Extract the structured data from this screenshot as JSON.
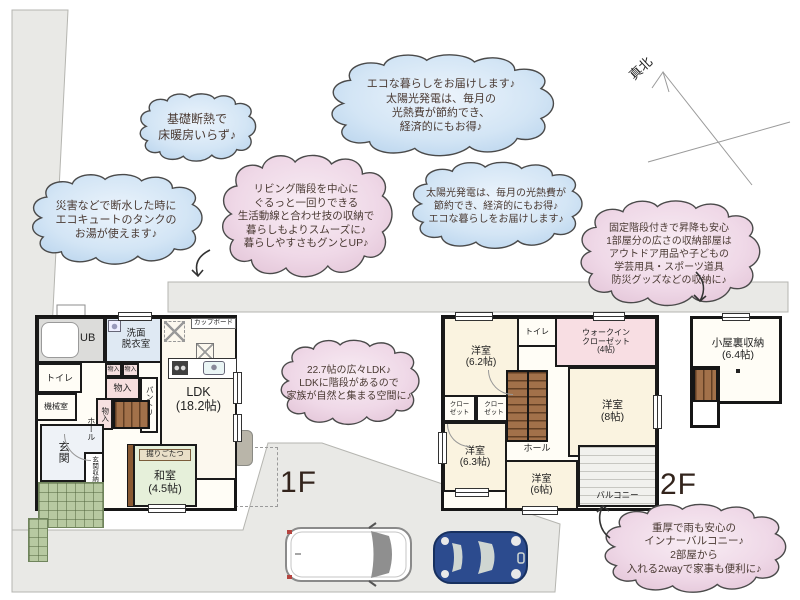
{
  "colors": {
    "cloud_blue": "#cfe3f4",
    "cloud_pink": "#f1d7e6",
    "site_gray": "#e9e9e6",
    "wall": "#1a1a1a",
    "tatami_green": "#e6f0da",
    "stairs_brown": "#a2714a",
    "car_blue": "#2c4b8e"
  },
  "compass": {
    "label": "真北"
  },
  "clouds": [
    {
      "name": "insulation",
      "text": "基礎断熱で\n床暖房いらず♪"
    },
    {
      "name": "eco-delivery",
      "text": "エコな暮らしをお届けします♪\n太陽光発電は、毎月の\n光熱費が節約でき、\n経済的にもお得♪"
    },
    {
      "name": "disaster-water",
      "text": "災害などで断水した時に\nエコキュートのタンクの\nお湯が使えます♪"
    },
    {
      "name": "living-stairs",
      "text": "リビング階段を中心に\nぐるっと一回りできる\n生活動線と合わせ技の収納で\n暮らしもよりスムーズに♪\n暮らしやすさもグンとUP♪"
    },
    {
      "name": "solar-power",
      "text": "太陽光発電は、毎月の光熱費が\n節約でき、経済的にもお得♪\nエコな暮らしをお届けします♪"
    },
    {
      "name": "attic-storage",
      "text": "固定階段付きで昇降も安心\n1部屋分の広さの収納部屋は\nアウトドア用品や子どもの\n学芸用具・スポーツ道具\n防災グッズなどの収納に♪"
    },
    {
      "name": "ldk-space",
      "text": "22.7帖の広々LDK♪\nLDKに階段があるので\n家族が自然と集まる空間に♪"
    },
    {
      "name": "inner-balcony",
      "text": "重厚で雨も安心の\nインナーバルコニー♪\n2部屋から\n入れる2wayで家事も便利に♪"
    }
  ],
  "floor1": {
    "label": "1F",
    "rooms": {
      "ub": "UB",
      "washroom": "洗面\n脱衣室",
      "toilet": "トイレ",
      "machine": "機械室",
      "entrance": "玄関",
      "entrance_storage": "玄関収納",
      "hall": "ホール",
      "storage_a": "物入",
      "storage_b": "物入",
      "storage_c": "物入",
      "storage_d": "物入",
      "pantry": "パントリー",
      "cupboard": "カップボード",
      "ldk": "LDK\n(18.2帖)",
      "kotatsu": "掘りごたつ",
      "washitsu": "和室\n(4.5帖)"
    }
  },
  "floor2": {
    "label": "2F",
    "rooms": {
      "bedroom_62": "洋室\n(6.2帖)",
      "toilet": "トイレ",
      "wic": "ウォークイン\nクローゼット\n(4帖)",
      "bedroom_8": "洋室\n(8帖)",
      "closet_a": "クロー\nゼット",
      "closet_b": "クロー\nゼット",
      "hall": "ホール",
      "bedroom_63": "洋室\n(6.3帖)",
      "bedroom_6": "洋室\n(6帖)",
      "balcony": "バルコニー"
    }
  },
  "attic": {
    "room": "小屋裏収納\n(6.4帖)"
  }
}
